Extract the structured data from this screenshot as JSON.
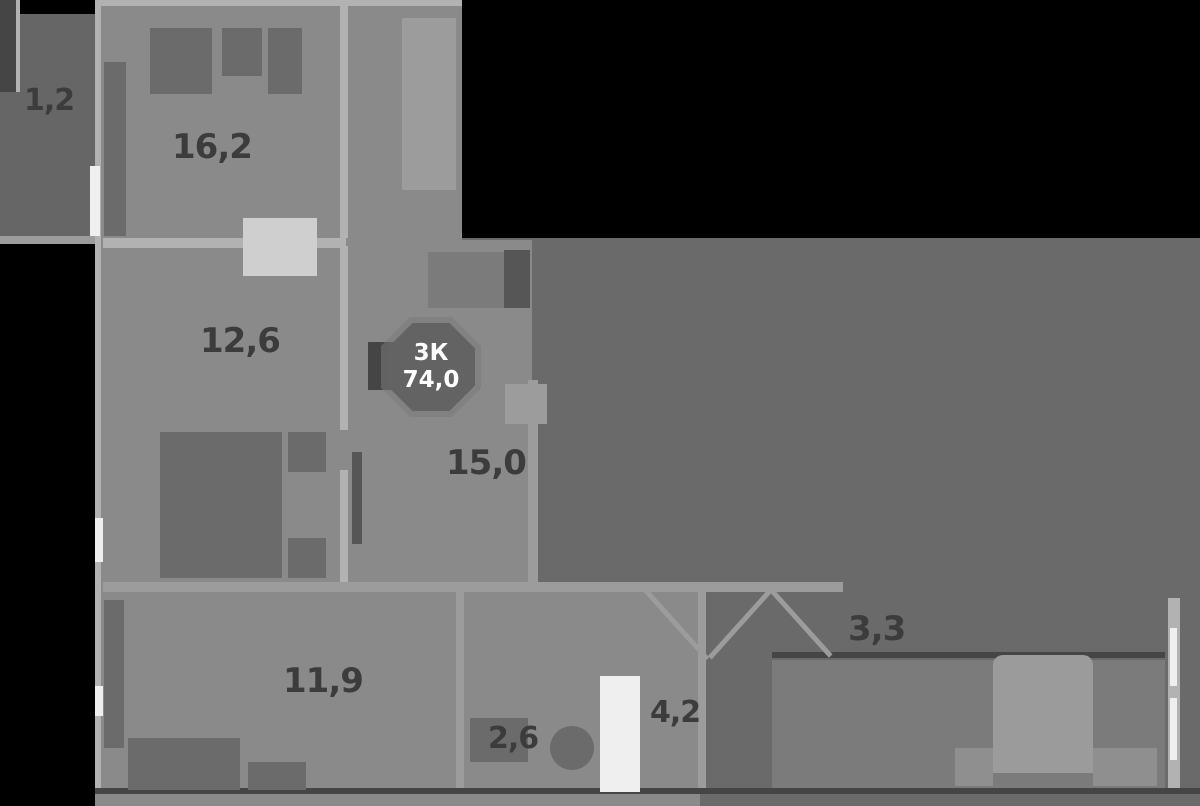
{
  "floorplan": {
    "badge": {
      "type_label": "3К",
      "area_label": "74,0"
    },
    "rooms": [
      {
        "id": "balcony-left",
        "area": "1,2"
      },
      {
        "id": "bedroom-top",
        "area": "16,2"
      },
      {
        "id": "bedroom-middle",
        "area": "12,6"
      },
      {
        "id": "living-room",
        "area": "15,0"
      },
      {
        "id": "hallway",
        "area": "11,9"
      },
      {
        "id": "bathroom",
        "area": "4,2"
      },
      {
        "id": "wc",
        "area": "2,6"
      },
      {
        "id": "loggia-right",
        "area": "3,3"
      }
    ]
  },
  "colors": {
    "bg": "#000000",
    "floor": "#8a8a8a",
    "floor_dark": "#6a6a6a",
    "floor_mid": "#7b7b7b",
    "balcony": "#666666",
    "wall": "#b2b2b2",
    "wall_soft": "#9c9c9c",
    "window": "#efefef",
    "furniture": "#6b6b6b",
    "furniture_dark": "#565656",
    "furniture_light": "#cfcfcf",
    "bed": "#9b9b9b",
    "bed_side": "#8f8f8f",
    "accent_dark": "#454545",
    "label": "#3c3c3c",
    "badge_bg": "#636363",
    "badge_ring": "#7a7a7a",
    "badge_text": "#ffffff"
  }
}
